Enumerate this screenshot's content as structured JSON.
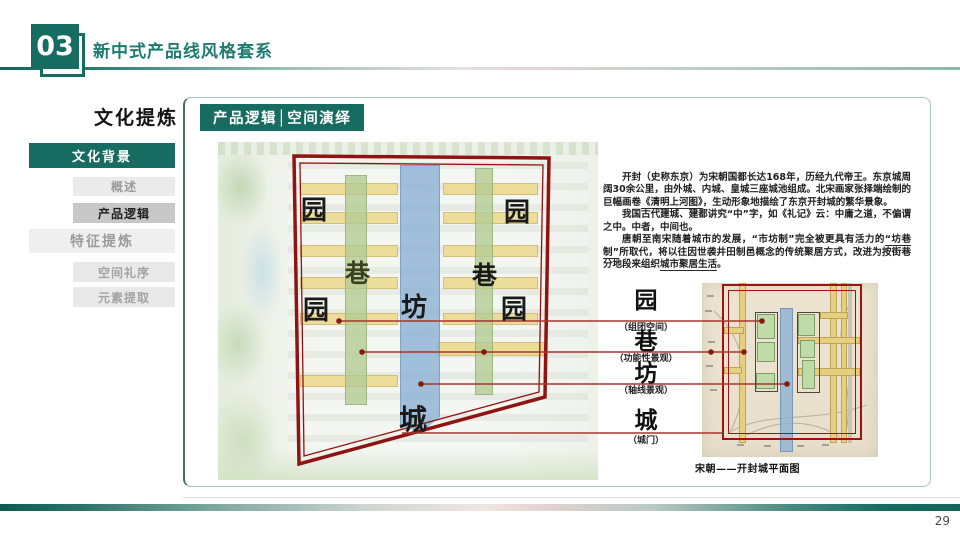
{
  "header": {
    "chapter_number": "03",
    "title": "新中式产品线风格套系"
  },
  "sidebar": {
    "title": "文化提炼",
    "items": [
      {
        "label": "文化背景",
        "state": "active"
      },
      {
        "label": "概述",
        "state": "sub"
      },
      {
        "label": "产品逻辑",
        "state": "sub-current"
      },
      {
        "label": "特征提炼",
        "state": "top"
      },
      {
        "label": "空间礼序",
        "state": "sub"
      },
      {
        "label": "元素提取",
        "state": "sub"
      }
    ]
  },
  "main": {
    "section_badge": "产品逻辑│空间演绎",
    "article": {
      "p1a": "开封（史称东京）",
      "p1b": "为宋朝国都长达168年，历经九代帝王。东京城周阔30余公里，由外城、内城、皇城三座城池组成。北宋画家张择端绘制的巨幅画卷",
      "p1c": "《清明上河图》",
      "p1d": "，生动形象地描绘了东京开封城的繁华景象。",
      "p2a": "我国古代建城、建都讲究",
      "p2b": "“中”",
      "p2c": "字，如《礼记》云：中庸之道，不偏谓之中。中者，中间也。",
      "p3a": "唐朝至南宋随着城市的发展，“市坊制”完全被更具有活力的",
      "p3b": "“坊巷制”",
      "p3c": "所取代，将以往因世袭井田制邑概念的传统聚居方式，改进为按街巷分地段来组织",
      "p3d": "城市聚居生活",
      "p3e": "。"
    },
    "diagram": {
      "chars": [
        "园",
        "园",
        "巷",
        "巷",
        "坊",
        "园",
        "园",
        "城"
      ]
    },
    "labels": [
      {
        "char": "园",
        "caption": "（组团空间）"
      },
      {
        "char": "巷",
        "caption": "（功能性景观）"
      },
      {
        "char": "坊",
        "caption": "（轴线景观）"
      },
      {
        "char": "城",
        "caption": "（城门）"
      }
    ],
    "map": {
      "caption": "宋朝——开封城平面图"
    }
  },
  "footer": {
    "page_number": "29"
  },
  "colors": {
    "accent_teal": "#176c61",
    "diagram_red": "#8f1411",
    "connector_red": "#a5372b",
    "strip_yellow": "#ecd98e",
    "strip_green": "#b3cc93",
    "strip_blue": "#8cb0d4",
    "map_paper": "#ebe3d0"
  }
}
